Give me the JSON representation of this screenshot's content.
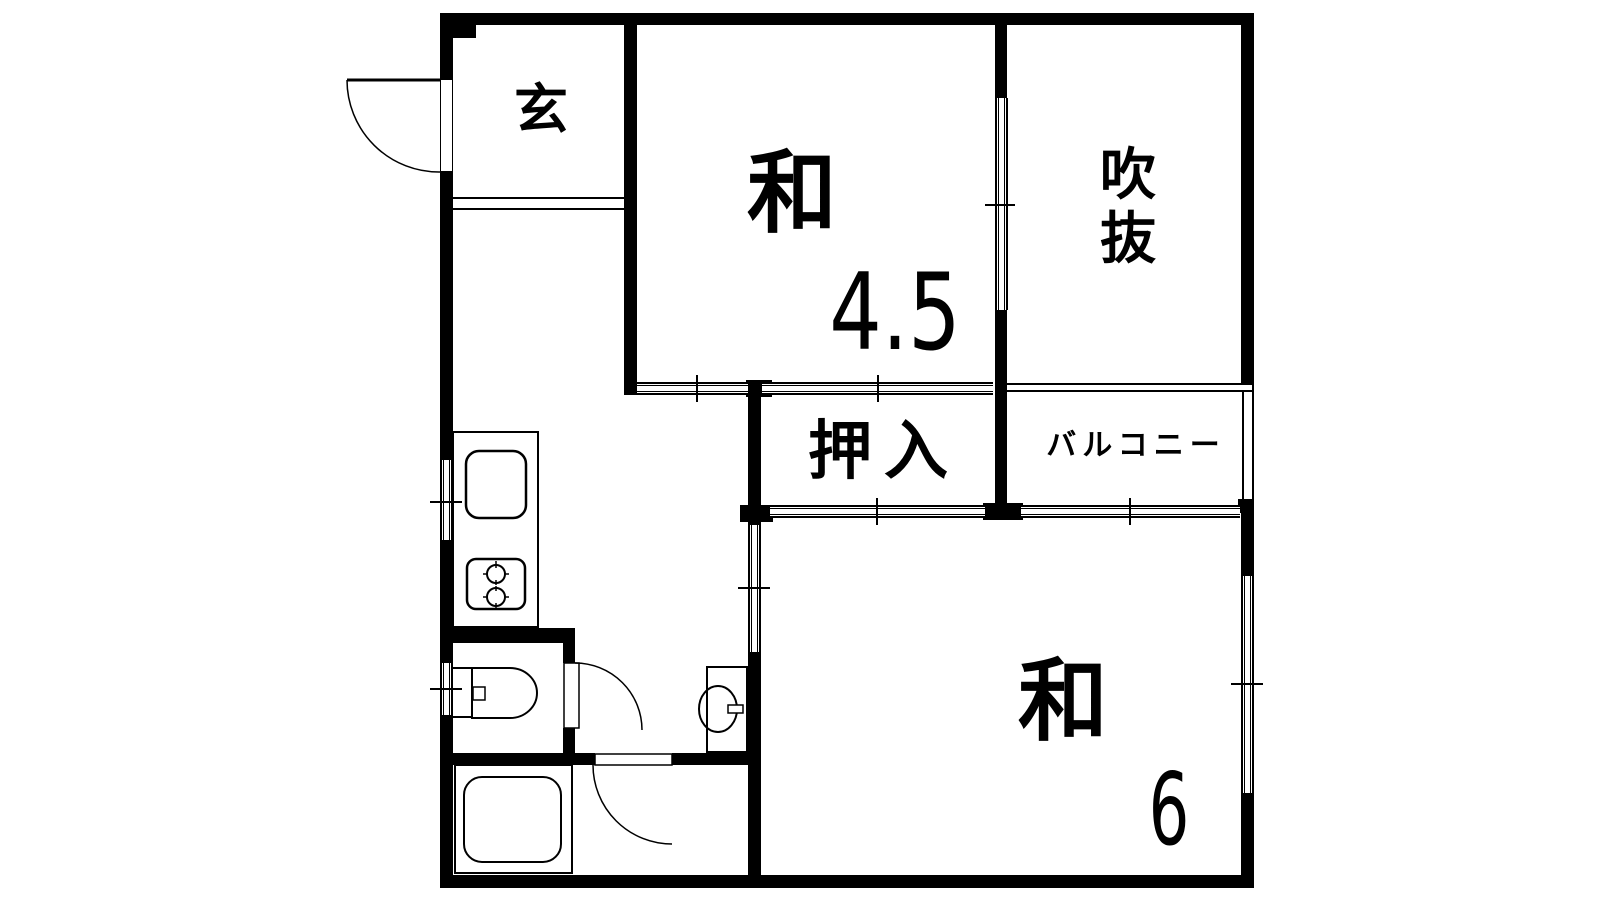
{
  "rooms": {
    "genkan": {
      "label": "玄"
    },
    "washitsu_45": {
      "name": "和",
      "size": "4.5"
    },
    "fukinuke": {
      "line1": "吹",
      "line2": "抜"
    },
    "oshiire": {
      "label": "押入"
    },
    "balcony": {
      "label": "バルコニー"
    },
    "washitsu_6": {
      "name": "和",
      "size": "6"
    }
  },
  "colors": {
    "wall": "#000000",
    "floor": "#ffffff"
  }
}
